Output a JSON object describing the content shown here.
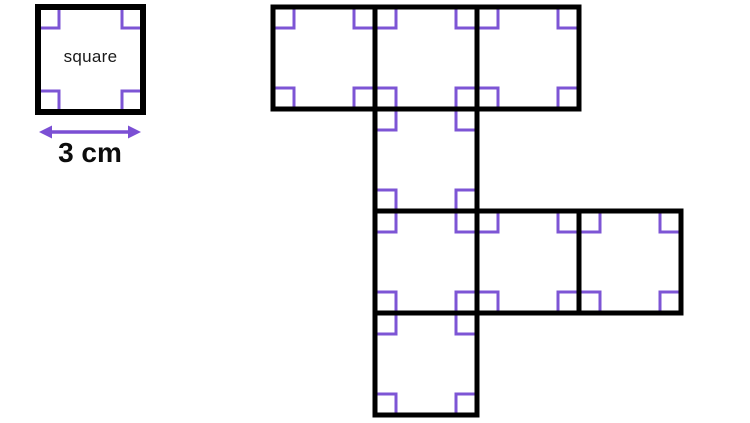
{
  "diagram": {
    "description": "Net of a solid made of congruent squares, with a labelled reference square",
    "reference_square": {
      "label": "square",
      "dimension_label": "3 cm",
      "x": 38,
      "y": 7,
      "size": 105,
      "stroke_width": 6
    },
    "net": {
      "origin_x": 273,
      "origin_y": 7,
      "cell_size": 102,
      "stroke_width": 5,
      "cells": [
        [
          0,
          0
        ],
        [
          1,
          0
        ],
        [
          2,
          0
        ],
        [
          1,
          1
        ],
        [
          1,
          2
        ],
        [
          2,
          2
        ],
        [
          3,
          2
        ],
        [
          1,
          3
        ]
      ]
    },
    "angle_marker": {
      "size": 21,
      "stroke_width": 3
    },
    "arrow": {
      "head_length": 13,
      "head_half_width": 6.5,
      "shaft_width": 3.5
    },
    "colors": {
      "outline": "#000000",
      "marker": "#7d55d5",
      "arrow": "#7b4fd4",
      "text": "#0d0d0d",
      "background": "#ffffff"
    }
  }
}
